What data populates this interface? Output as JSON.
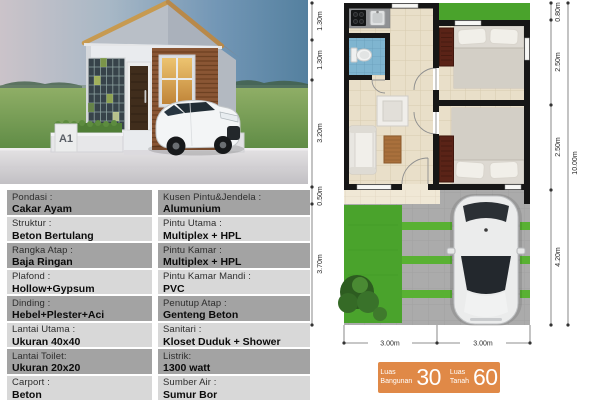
{
  "photo": {
    "sign": "A1"
  },
  "specs": {
    "left": [
      {
        "label": "Pondasi :",
        "value": "Cakar Ayam"
      },
      {
        "label": "Struktur :",
        "value": "Beton Bertulang"
      },
      {
        "label": "Rangka Atap :",
        "value": "Baja Ringan"
      },
      {
        "label": "Plafond :",
        "value": "Hollow+Gypsum"
      },
      {
        "label": "Dinding :",
        "value": "Hebel+Plester+Aci"
      },
      {
        "label": "Lantai Utama :",
        "value": "Ukuran 40x40"
      },
      {
        "label": "Lantai Toilet:",
        "value": "Ukuran 20x20"
      },
      {
        "label": "Carport :",
        "value": "Beton"
      }
    ],
    "right": [
      {
        "label": "Kusen Pintu&Jendela :",
        "value": "Alumunium"
      },
      {
        "label": "Pintu Utama :",
        "value": "Multiplex + HPL"
      },
      {
        "label": "Pintu Kamar :",
        "value": "Multiplex + HPL"
      },
      {
        "label": "Pintu Kamar Mandi :",
        "value": "PVC"
      },
      {
        "label": "Penutup Atap :",
        "value": "Genteng Beton"
      },
      {
        "label": "Sanitari :",
        "value": "Kloset Duduk + Shower"
      },
      {
        "label": "Listrik:",
        "value": "1300 watt"
      },
      {
        "label": "Sumber Air :",
        "value": "Sumur Bor"
      }
    ]
  },
  "floor_plan": {
    "dims_left": [
      "1.30m",
      "1.30m",
      "3.20m",
      "0.50m",
      "3.70m"
    ],
    "dims_right": [
      "0.80m",
      "2.50m",
      "2.50m",
      "4.20m"
    ],
    "dim_total": "10.00m",
    "dims_bottom": [
      "3.00m",
      "3.00m"
    ]
  },
  "badge": {
    "bangunan_label_1": "Luas",
    "bangunan_label_2": "Bangunan",
    "bangunan_value": "30",
    "tanah_label_1": "Luas",
    "tanah_label_2": "Tanah",
    "tanah_value": "60"
  },
  "colors": {
    "badge_orange": "#e08947",
    "spec_row_dark": "#a3a3a3",
    "spec_row_light": "#d8d8d8",
    "plan_wall": "#161616",
    "grass_green": "#4aa32c"
  }
}
